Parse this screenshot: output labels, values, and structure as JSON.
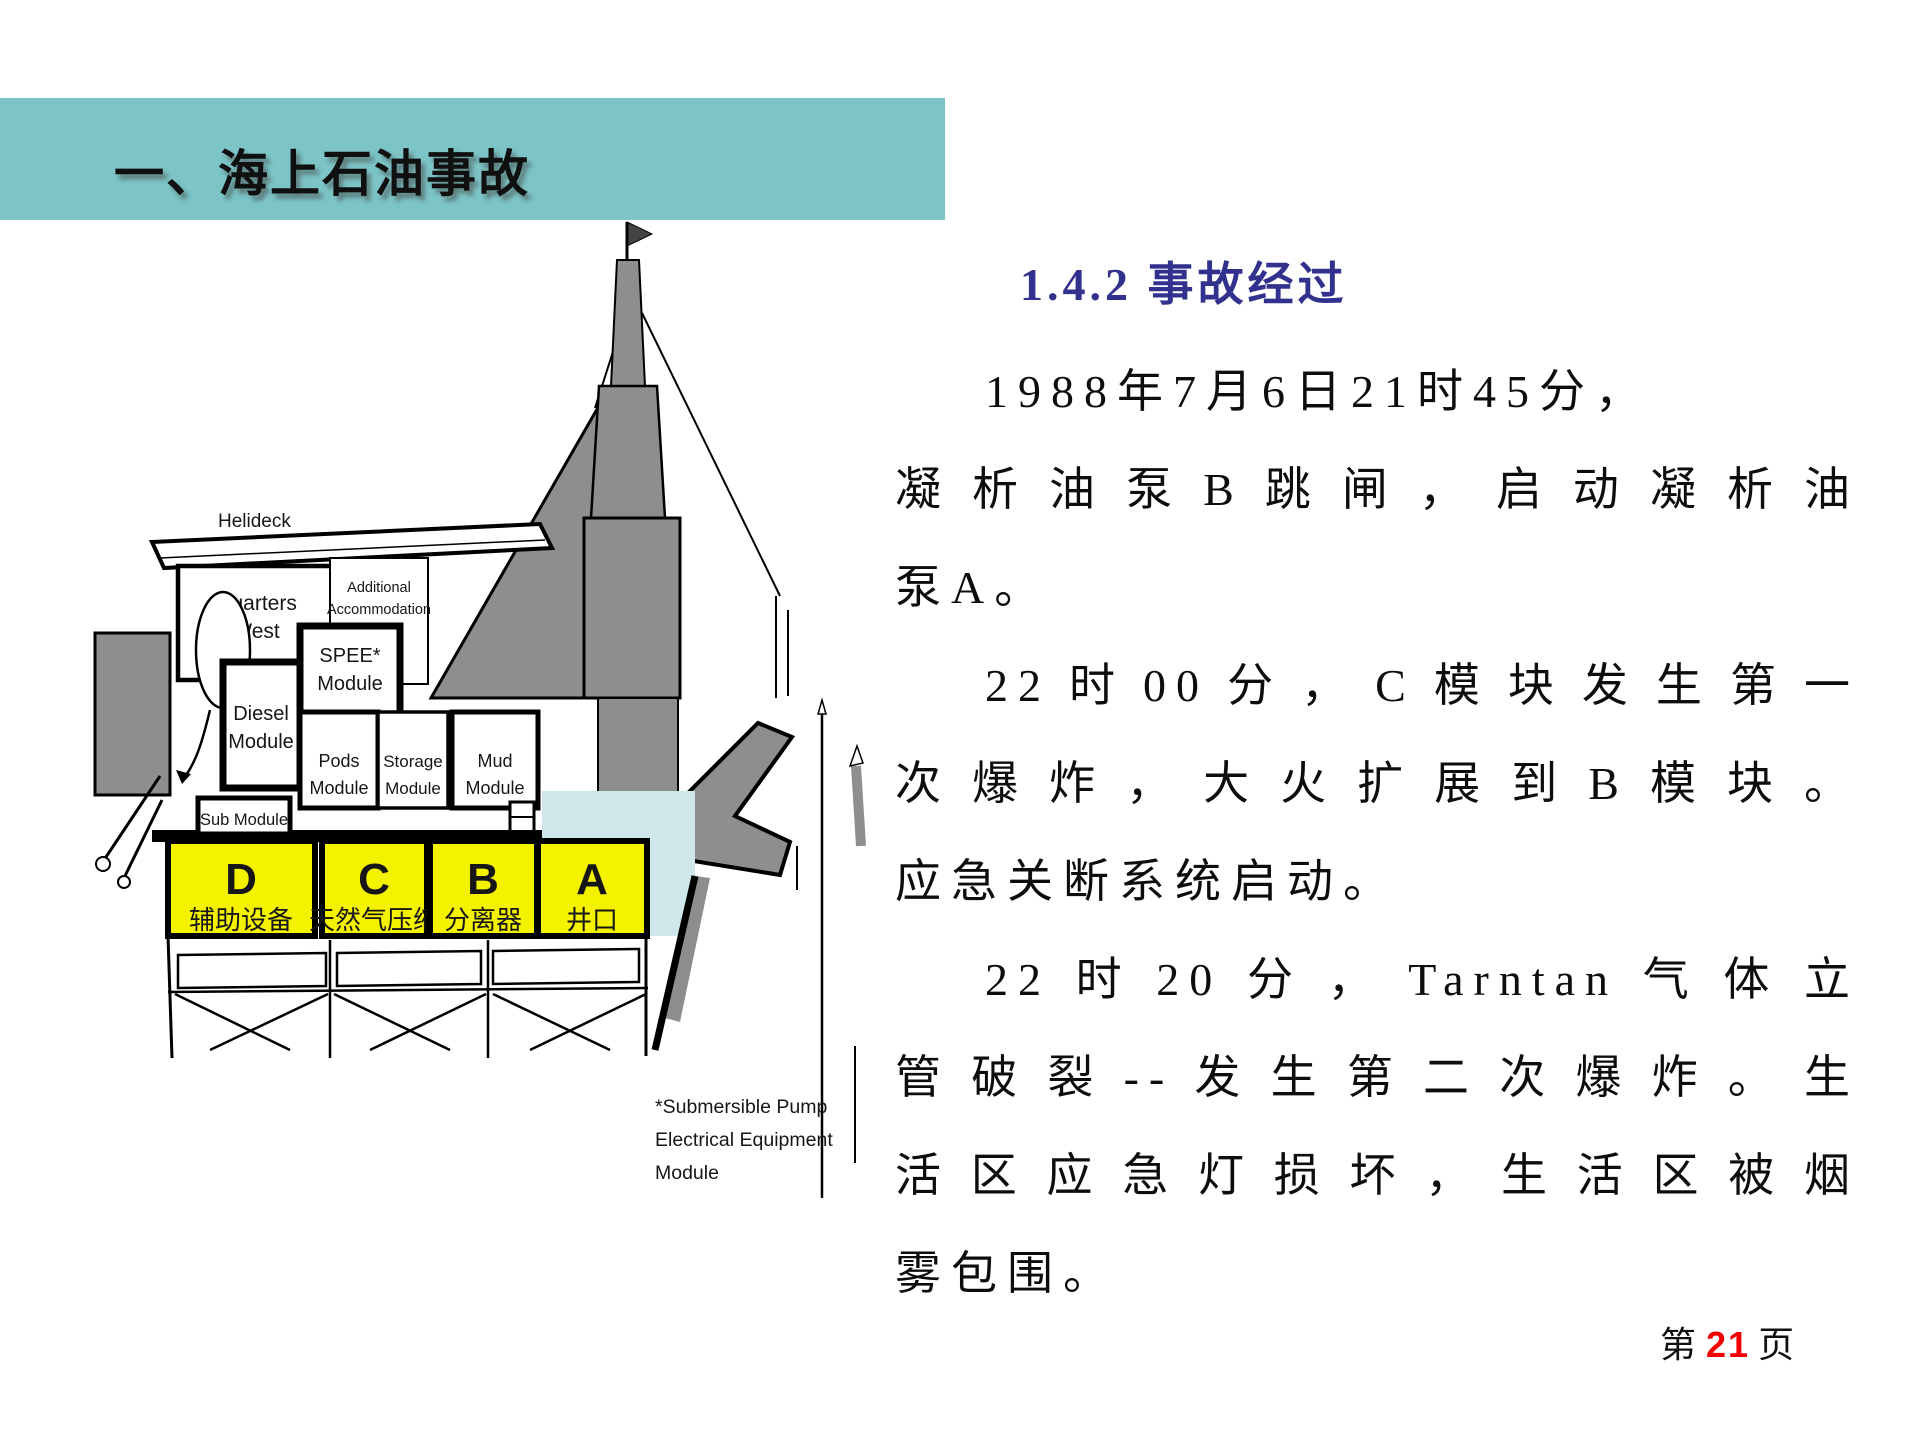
{
  "slide": {
    "header": {
      "title": "一、海上石油事故"
    },
    "heading": "1.4.2  事故经过",
    "paragraph_lines": [
      "1988年7月6日21时45分，",
      "凝析油泵B跳闸，启动凝析油",
      "泵A。",
      "22时00分，C模块发生第一",
      "次爆炸，大火扩展到B模块。",
      "应急关断系统启动。",
      "22时20分，Tarntan气体立",
      "管破裂--发生第二次爆炸。生",
      "活区应急灯损坏，生活区被烟",
      "雾包围。"
    ],
    "footer": {
      "prefix": "第",
      "page_number": "21",
      "suffix": "页"
    },
    "colors": {
      "header_band": "#7cc4c6",
      "heading_text": "#32328e",
      "module_yellow": "#f5f200",
      "module_letter_gray": "#8c8c99",
      "page_number_red": "#f40000",
      "diagram_gray": "#8e8e8e",
      "cyan_block": "#cfe7ea"
    }
  },
  "diagram": {
    "helideck_label": "Helideck",
    "quarters_west": {
      "line1": "Quarters",
      "line2": "West"
    },
    "additional_accommodation": {
      "line1": "Additional",
      "line2": "Accommodation",
      "line3": "West"
    },
    "spee_module": {
      "line1": "SPEE*",
      "line2": "Module"
    },
    "diesel_module": {
      "line1": "Diesel",
      "line2": "Module"
    },
    "pods_module": {
      "line1": "Pods",
      "line2": "Module"
    },
    "storage_module": {
      "line1": "Storage",
      "line2": "Module"
    },
    "mud_module": {
      "line1": "Mud",
      "line2": "Module"
    },
    "sub_module_label": "Sub Module",
    "deck_modules": [
      {
        "letter": "D",
        "label": "辅助设备"
      },
      {
        "letter": "C",
        "label": "天然气压缩"
      },
      {
        "letter": "B",
        "label": "分离器"
      },
      {
        "letter": "A",
        "label": "井口"
      }
    ],
    "footnote": {
      "line1": "*Submersible Pump",
      "line2": "Electrical Equipment",
      "line3": "Module"
    }
  }
}
